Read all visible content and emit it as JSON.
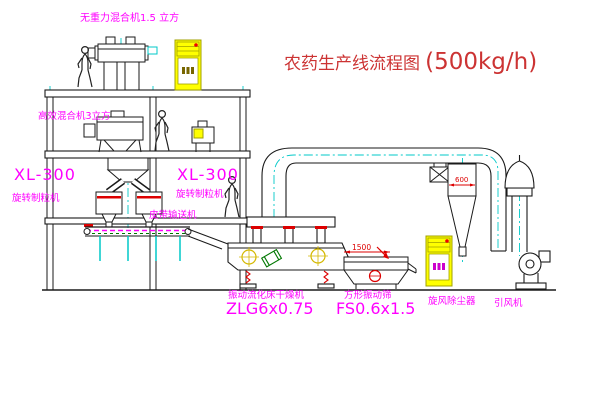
{
  "title": {
    "cn": "农药生产线流程图",
    "capacity": "(500kg/h)",
    "color": "#cc3333"
  },
  "labels": {
    "top_mixer": "无重力混合机1.5 立方",
    "mid_mixer": "高效混合机3立方",
    "granulator_left": {
      "model": "XL-300",
      "name": "旋转制粒机"
    },
    "granulator_right": {
      "model": "XL-300",
      "name": "旋转制粒机"
    },
    "belt_conveyor": "皮带输送机",
    "dryer": {
      "name": "振动流化床干燥机",
      "model": "ZLG6x0.75"
    },
    "sieve": {
      "name": "方形振动筛",
      "model": "FS0.6x1.5"
    },
    "cyclone": "旋风除尘器",
    "fan": "引风机"
  },
  "dimensions": {
    "sieve_length": "1500",
    "cyclone_diameter": "600"
  },
  "colors": {
    "label": "#ff00ff",
    "line": "#1a1a1a",
    "centerline": "#00c8c8",
    "cabinet_fill": "#ffff00",
    "dimension": "#dd0000",
    "accent_green": "#007700",
    "accent_yellow": "#d4b800"
  }
}
